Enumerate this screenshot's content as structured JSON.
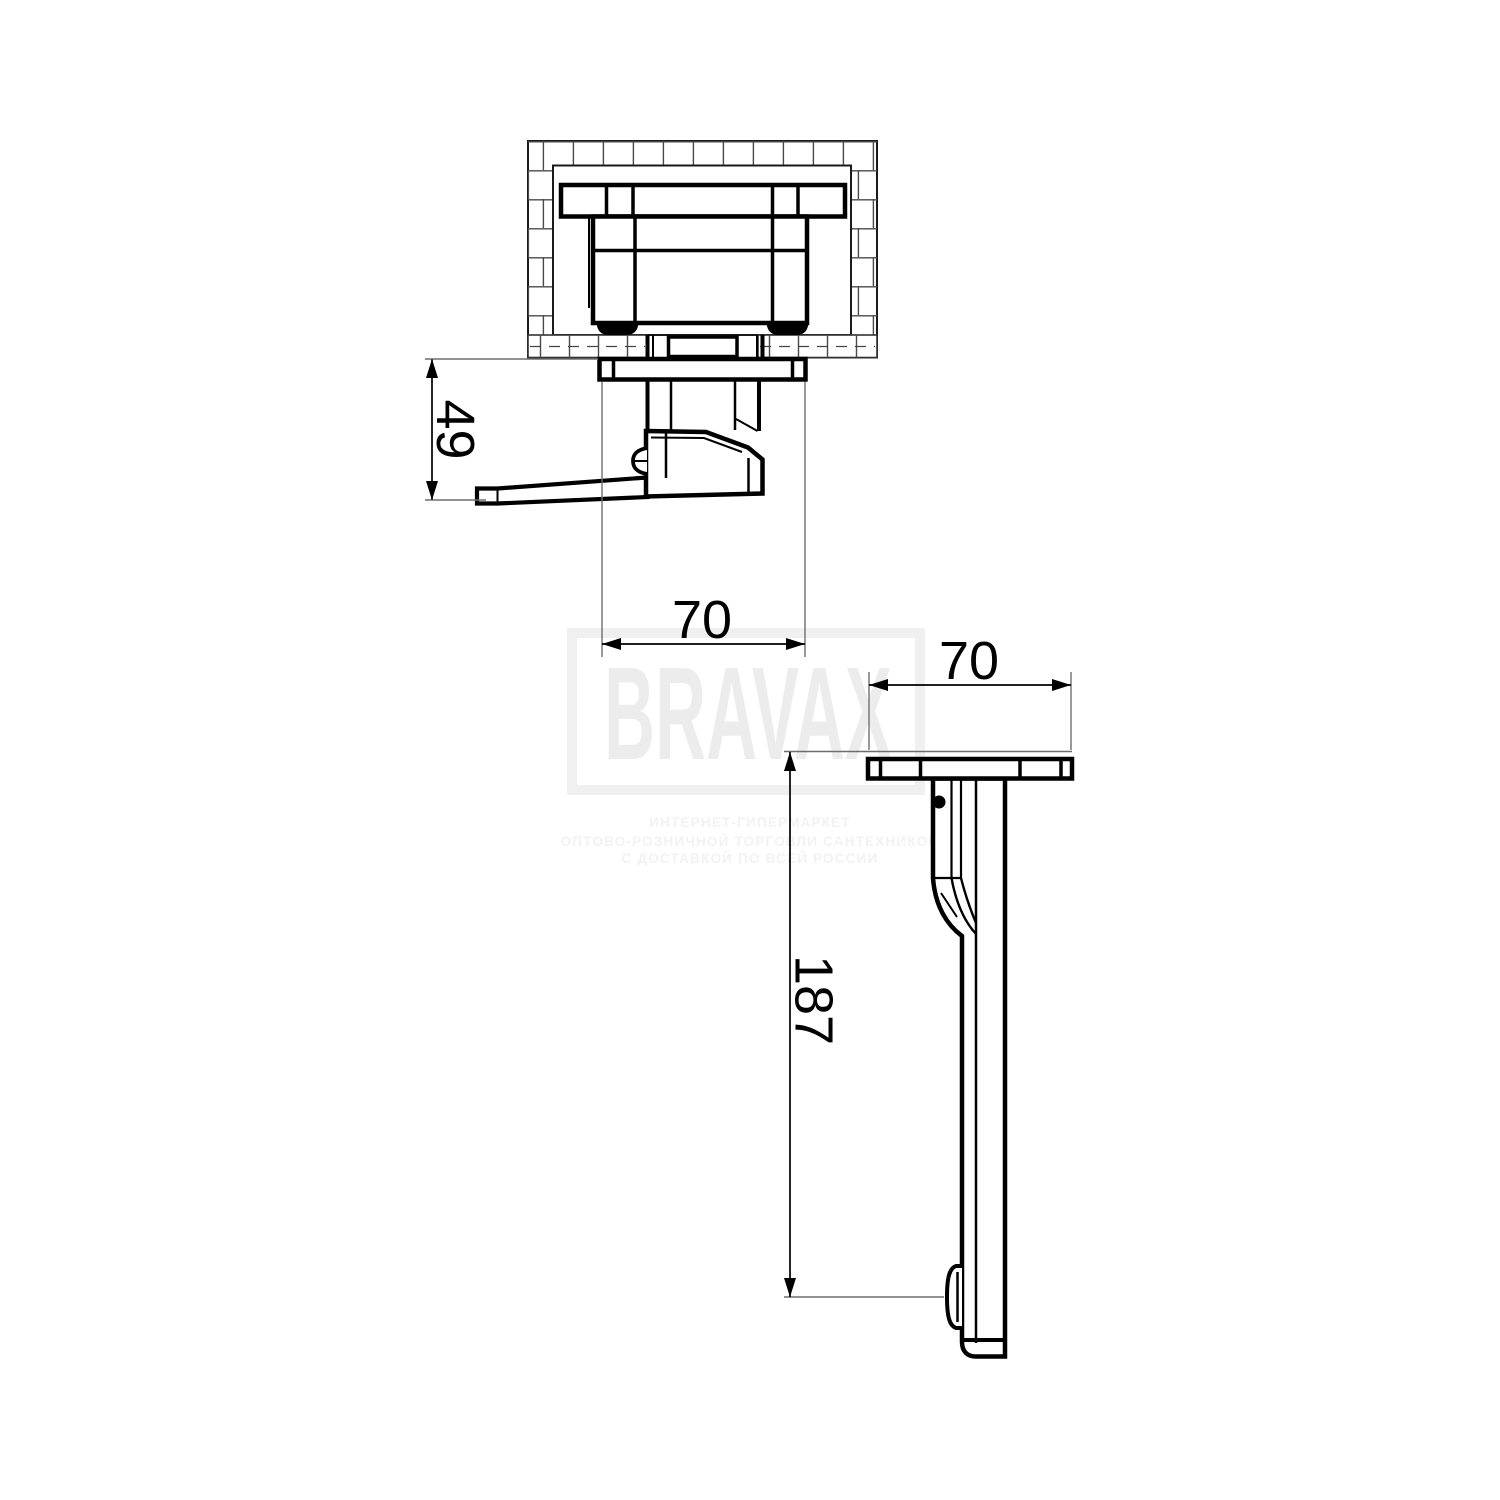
{
  "watermark": {
    "brand": "BRAVAX",
    "tagline_lines": [
      "ИНТЕРНЕТ-ГИПЕРМАРКЕТ",
      "ОПТОВО-РОЗНИЧНОЙ ТОРГОВЛИ САНТЕХНИКОЙ",
      "С ДОСТАВКОЙ ПО ВСЕЙ РОССИИ"
    ],
    "brand_color": "#ececec",
    "frame_color": "#f0f0f0",
    "tagline_color": "#f2f2f2"
  },
  "drawing": {
    "type": "installation-dimension-drawing",
    "line_color": "#000000",
    "extension_line_color": "#6e6e6e",
    "dimensions": {
      "section_view": {
        "depth": "49",
        "width": "70"
      },
      "side_view": {
        "width": "70",
        "length": "187"
      }
    }
  }
}
